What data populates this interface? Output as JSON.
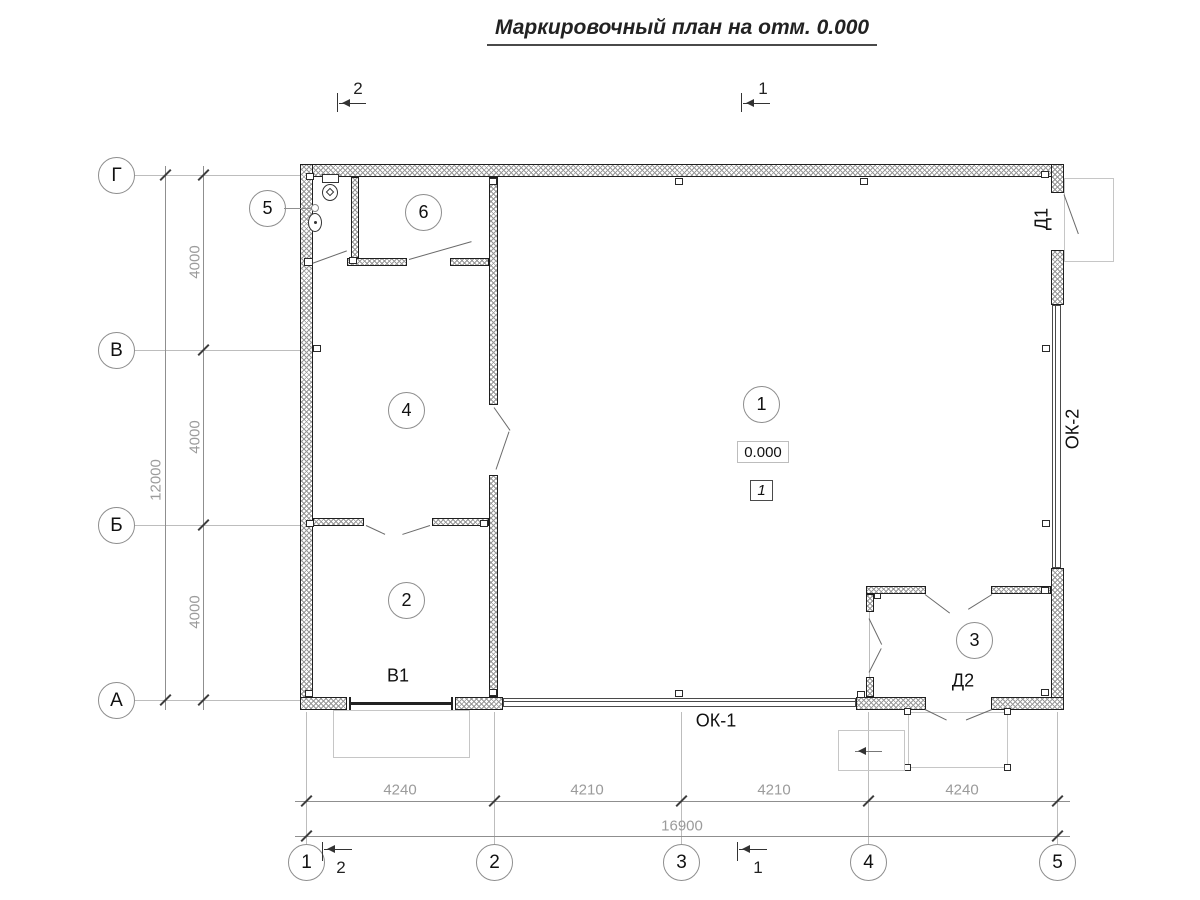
{
  "title": "Маркировочный план на отм. 0.000",
  "section_marks": {
    "top_2": "2",
    "top_1": "1",
    "bottom_2": "2",
    "bottom_1": "1"
  },
  "grid": {
    "rows": [
      "Г",
      "В",
      "Б",
      "А"
    ],
    "cols": [
      "1",
      "2",
      "3",
      "4",
      "5"
    ]
  },
  "dims": {
    "vertical": {
      "segments": [
        "4000",
        "4000",
        "4000"
      ],
      "total": "12000"
    },
    "horizontal": {
      "segments": [
        "4240",
        "4210",
        "4210",
        "4240"
      ],
      "total": "16900"
    }
  },
  "rooms": {
    "r1": "1",
    "r2": "2",
    "r3": "3",
    "r4": "4",
    "r5": "5",
    "r6": "6"
  },
  "marks": {
    "elevation": "0.000",
    "floor_type": "1",
    "gate_b1": "В1",
    "door_d1": "Д1",
    "door_d2": "Д2",
    "window_ok1": "ОК-1",
    "window_ok2": "ОК-2"
  },
  "colors": {
    "wall_line": "#1f1f1f",
    "dim_text": "#9b9b9b",
    "extension_line": "#bdbdbd"
  }
}
